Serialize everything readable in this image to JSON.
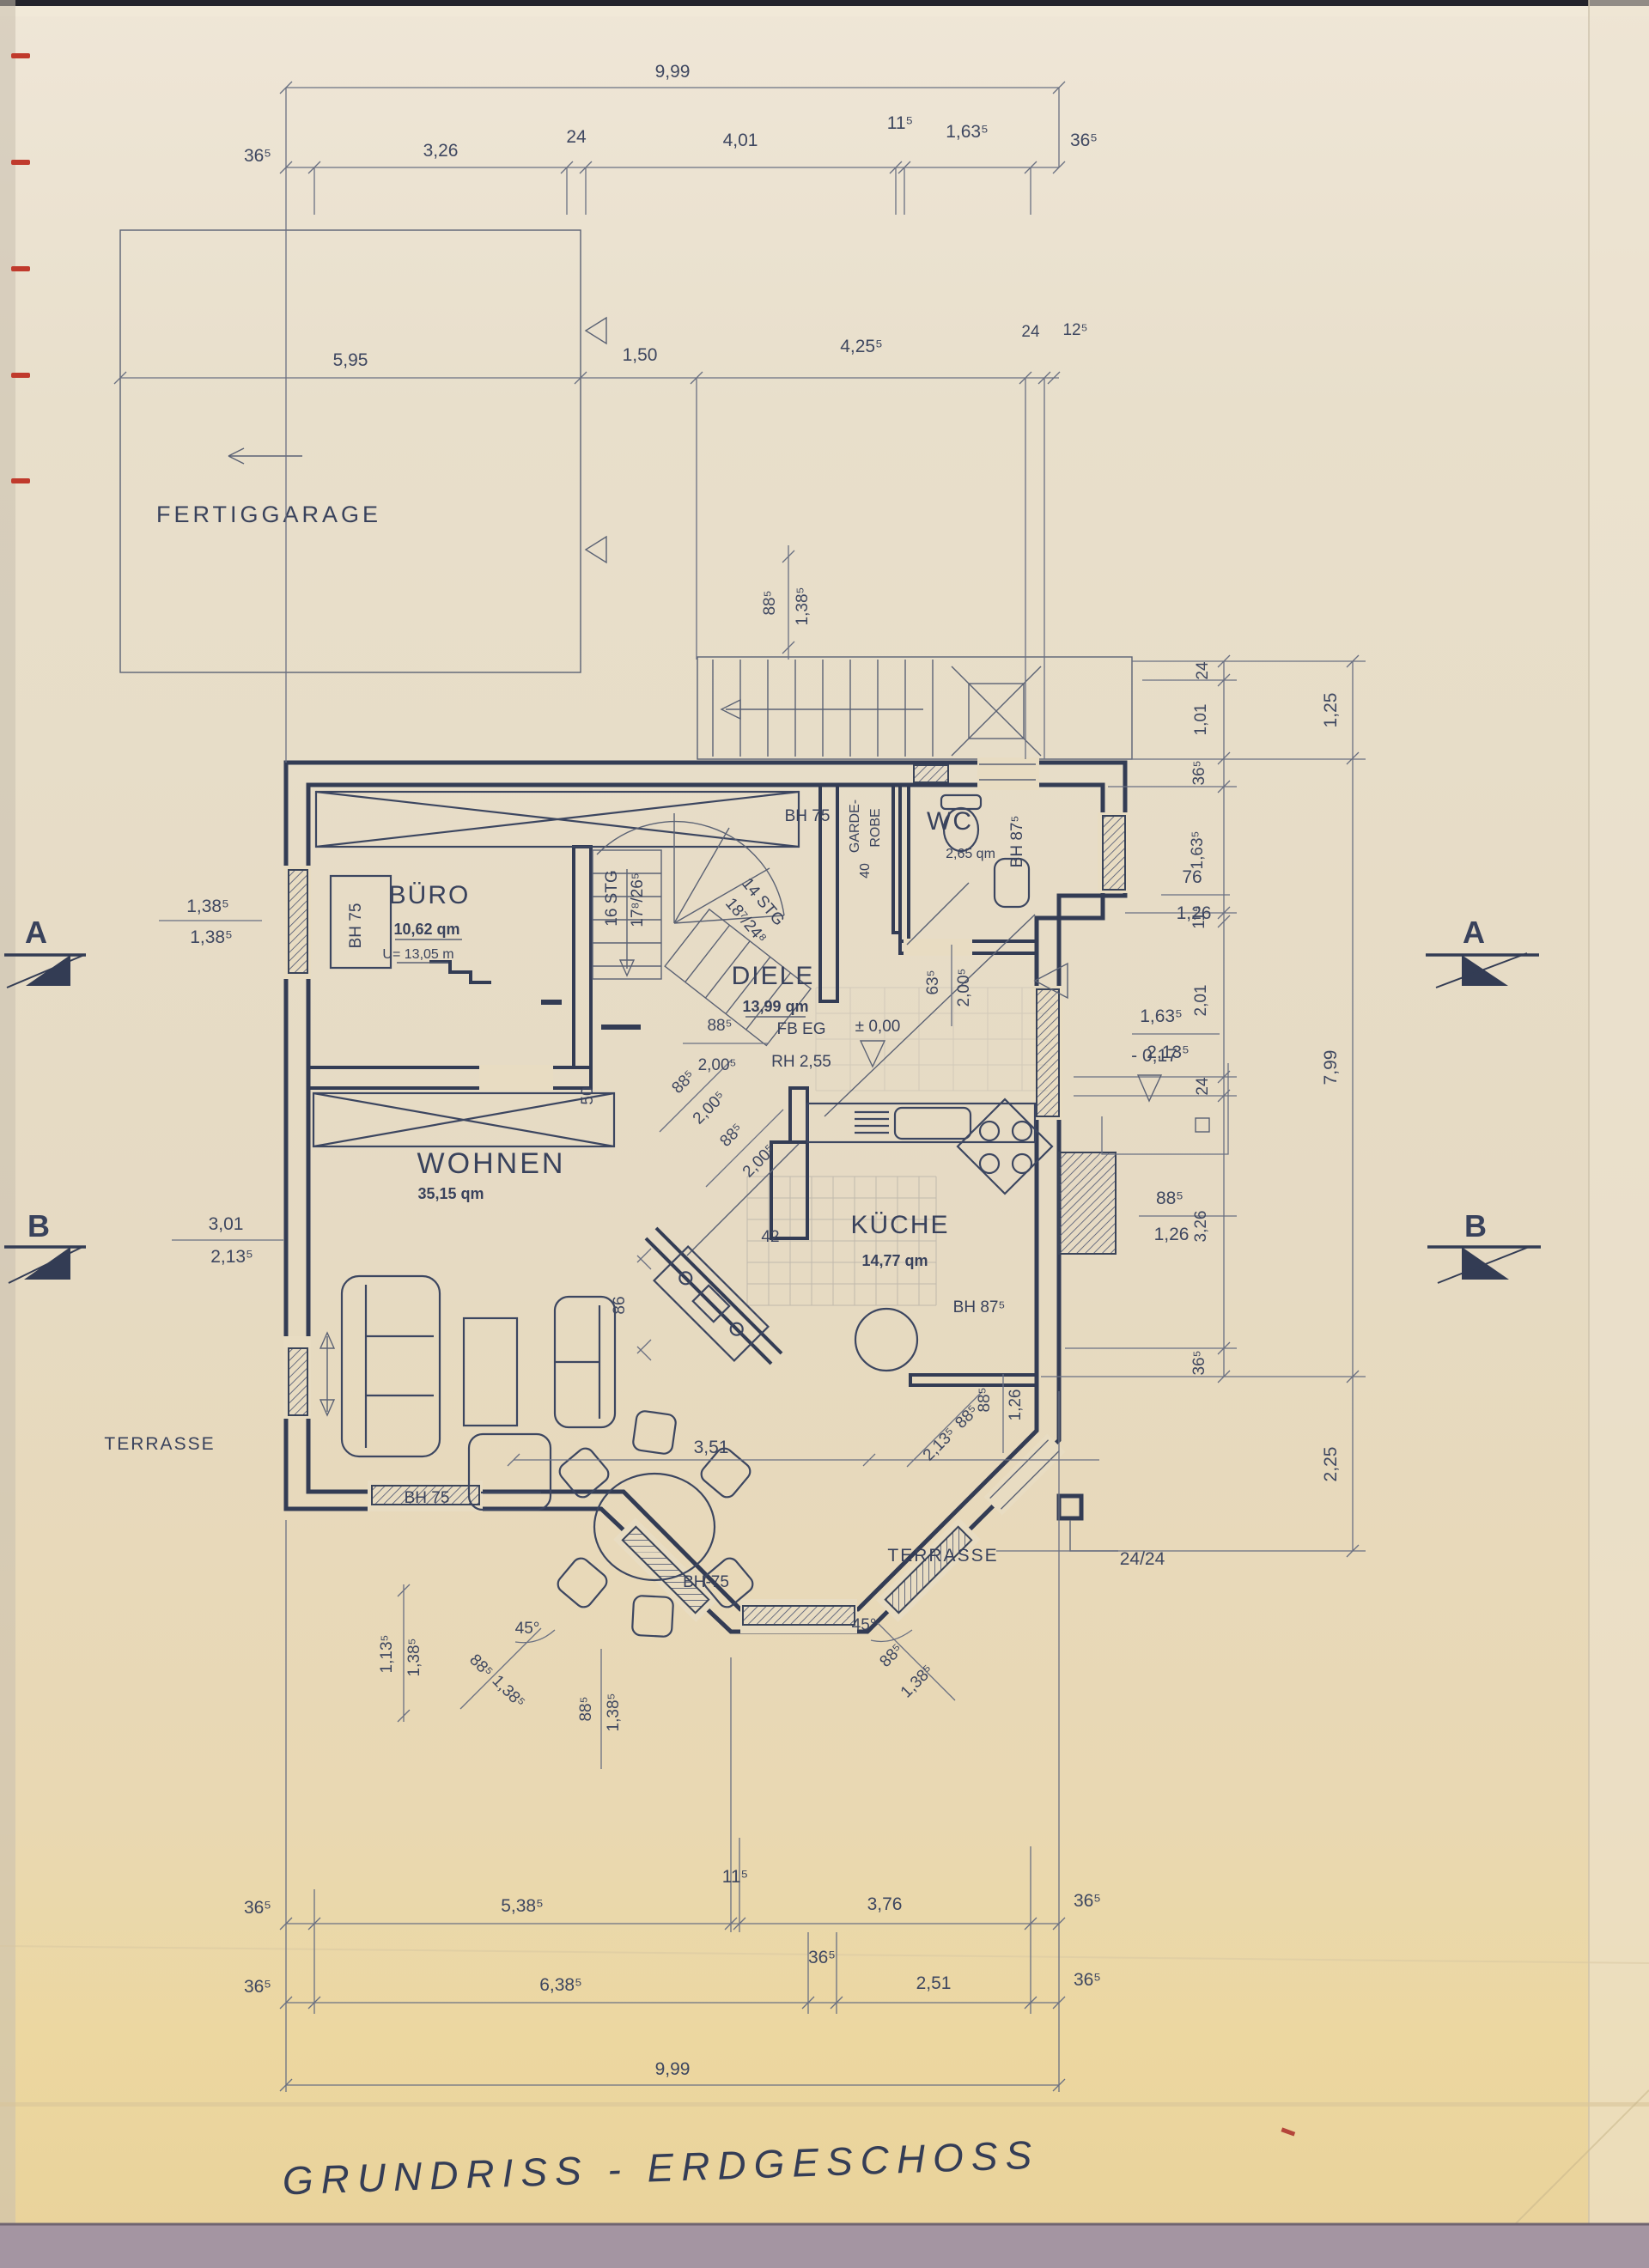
{
  "title": "GRUNDRISS  -  ERDGESCHOSS",
  "garage": {
    "name": "FERTIGGARAGE"
  },
  "rooms": {
    "buero": {
      "name": "BÜRO",
      "area": "10,62 qm",
      "umfang": "U= 13,05 m"
    },
    "wohnen": {
      "name": "WOHNEN",
      "area": "35,15 qm"
    },
    "kueche": {
      "name": "KÜCHE",
      "area": "14,77 qm",
      "bh": "BH 87⁵"
    },
    "diele": {
      "name": "DIELE",
      "area": "13,99 qm",
      "fb": "FB EG",
      "level": "± 0,00",
      "rh": "RH 2,55"
    },
    "wc": {
      "name": "WC",
      "area": "2,65 qm",
      "bh": "BH 87⁵"
    },
    "garderobe": {
      "line1": "GARDE-",
      "line2": "ROBE",
      "depth": "40"
    },
    "terrasse_west": "TERRASSE",
    "terrasse_south": "TERRASSE"
  },
  "stairs": {
    "main_l1": "16 STG",
    "main_l2": "17⁸/26⁵",
    "lower_l1": "14 STG",
    "lower_l2": "18⁷/24⁸"
  },
  "bh": {
    "buero_window": "BH 75",
    "stair": "BH 75",
    "south_window": "BH  75",
    "bay": "BH-75"
  },
  "sections": {
    "a": "A",
    "b": "B"
  },
  "post": "24/24",
  "levels": {
    "entry": "- 0,17"
  },
  "dims": {
    "top_total": "9,99",
    "top": [
      "36⁵",
      "3,26",
      "24",
      "4,01",
      "11⁵",
      "1,63⁵",
      "36⁵"
    ],
    "garage": [
      "5,95",
      "1,50",
      "4,25⁵",
      "24",
      "12⁵"
    ],
    "stair_width": [
      "88⁵",
      "1,38⁵"
    ],
    "right_inner": [
      "24",
      "1,01",
      "36⁵",
      "1,63⁵",
      "11⁵",
      "2,01",
      "24",
      "3,26",
      "36⁵"
    ],
    "right_outer": [
      "1,25",
      "7,99",
      "2,25"
    ],
    "left_a": [
      "1,38⁵",
      "1,38⁵"
    ],
    "left_b": [
      "3,01",
      "2,13⁵"
    ],
    "bottom1": [
      "36⁵",
      "5,38⁵",
      "11⁵",
      "3,76",
      "36⁵"
    ],
    "bottom2": [
      "36⁵",
      "6,38⁵",
      "36⁵",
      "2,51",
      "36⁵"
    ],
    "bottom_total": "9,99",
    "stair_door": [
      "88⁵",
      "2,00⁵"
    ],
    "wc_door": [
      "63⁵",
      "2,00⁵"
    ],
    "wohnen_door": [
      "88⁵",
      "2,00⁵"
    ],
    "corridor_door": [
      "88⁵",
      "2,00⁵"
    ],
    "stub": "50",
    "stub2": "42",
    "chimney": "86",
    "bay_width": "3,51",
    "bay_left": [
      "88⁵",
      "1,38⁵"
    ],
    "bay_bottom": [
      "88⁵",
      "1,38⁵"
    ],
    "bay_right": [
      "88⁵",
      "1,38⁵"
    ],
    "west_low": [
      "1,13⁵",
      "1,38⁵"
    ],
    "kitchen_door_v": [
      "88⁵",
      "1,26"
    ],
    "kitchen_door_d": [
      "88⁵",
      "2,13⁵"
    ],
    "angle_left": "45°",
    "angle_right": "45°",
    "win_east1": [
      "76",
      "1,26"
    ],
    "win_east2": [
      "1,63⁵",
      "2,13⁵"
    ],
    "win_kitchen": [
      "88⁵",
      "1,26"
    ]
  }
}
